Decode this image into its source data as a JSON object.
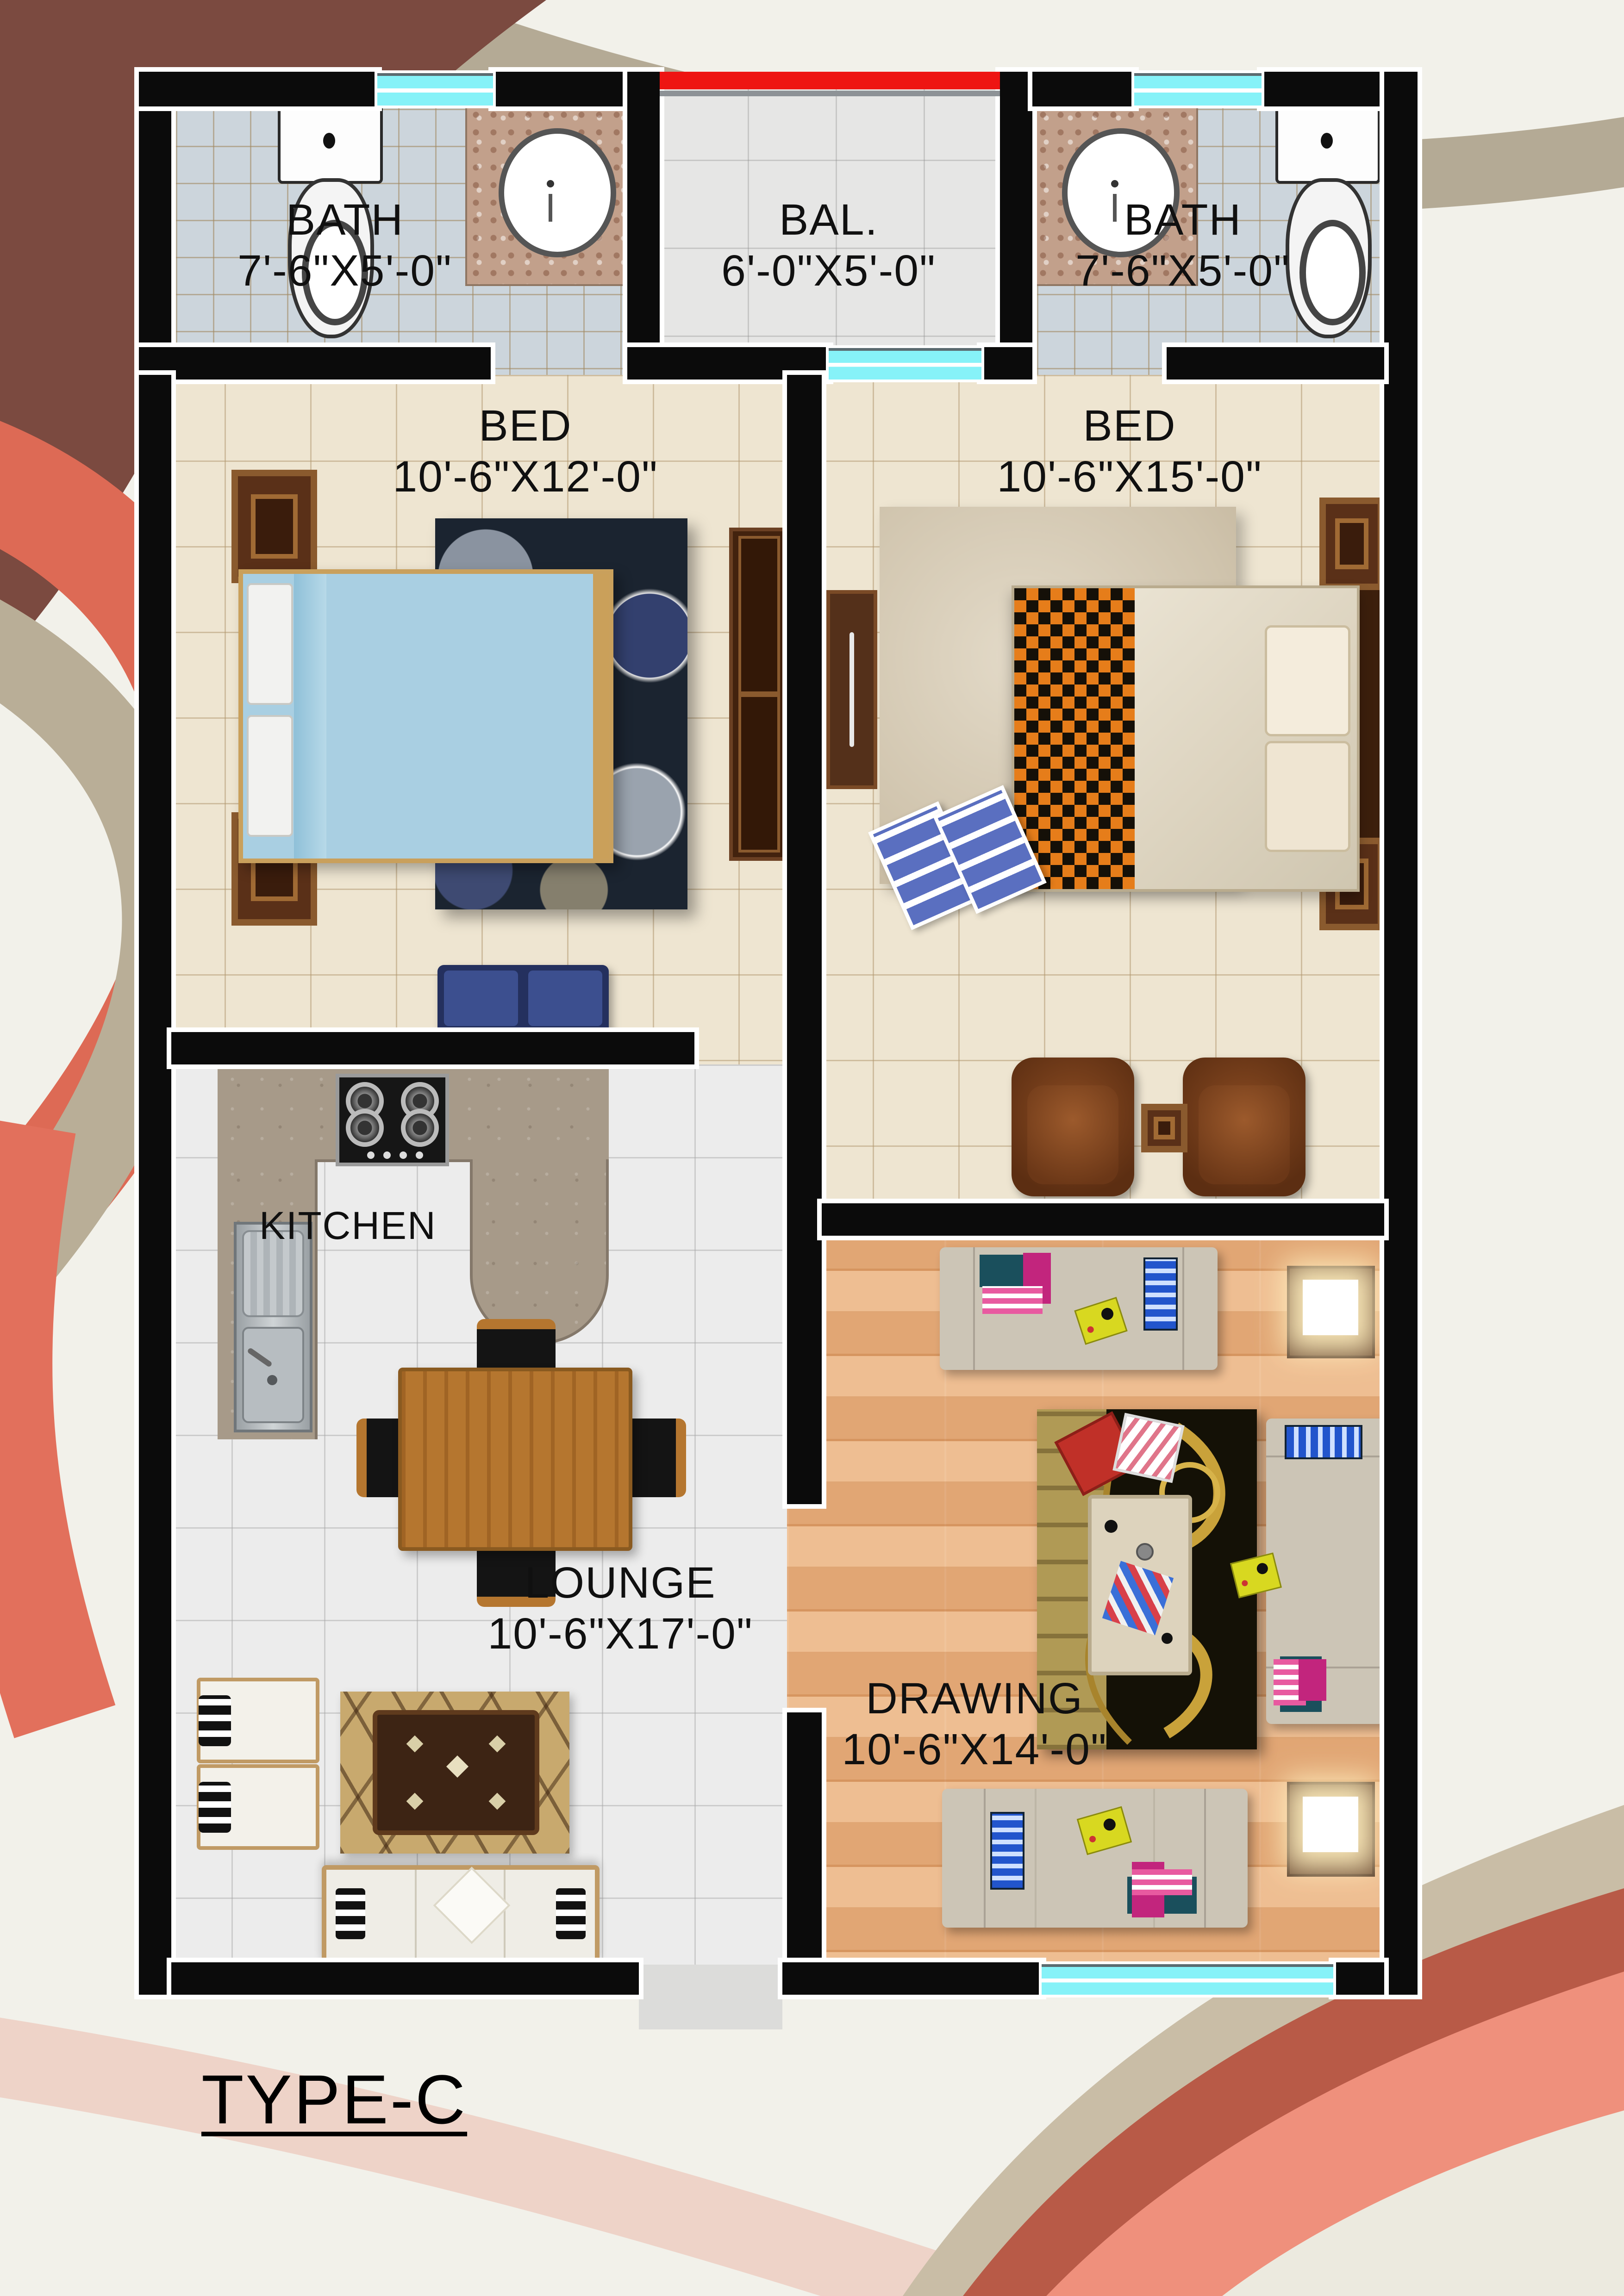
{
  "title": "TYPE-C",
  "rooms": {
    "bath_left": {
      "name": "BATH",
      "dims": "7'-6\"X5'-0\""
    },
    "balcony": {
      "name": "BAL.",
      "dims": "6'-0\"X5'-0\""
    },
    "bath_right": {
      "name": "BATH",
      "dims": "7'-6\"X5'-0\""
    },
    "bed_left": {
      "name": "BED",
      "dims": "10'-6\"X12'-0\""
    },
    "bed_right": {
      "name": "BED",
      "dims": "10'-6\"X15'-0\""
    },
    "kitchen": {
      "name": "KITCHEN"
    },
    "lounge": {
      "name": "LOUNGE",
      "dims": "10'-6\"X17'-0\""
    },
    "drawing": {
      "name": "DRAWING",
      "dims": "10'-6\"X14'-0\""
    }
  },
  "colors": {
    "wall": "#0b0b0b",
    "window_glass": "#86f2f8",
    "balcony_railing": "#ee1512",
    "bath_tile": "#ccd5dc",
    "bedroom_floor": "#eee5d1",
    "lounge_floor": "#ececec",
    "drawing_wood_floor": "#e9b183",
    "kitchen_counter": "#a79a89",
    "accent_swirl_red": "#dd6a55",
    "accent_swirl_maroon": "#7b4a40",
    "accent_swirl_tan": "#c9bda6"
  }
}
